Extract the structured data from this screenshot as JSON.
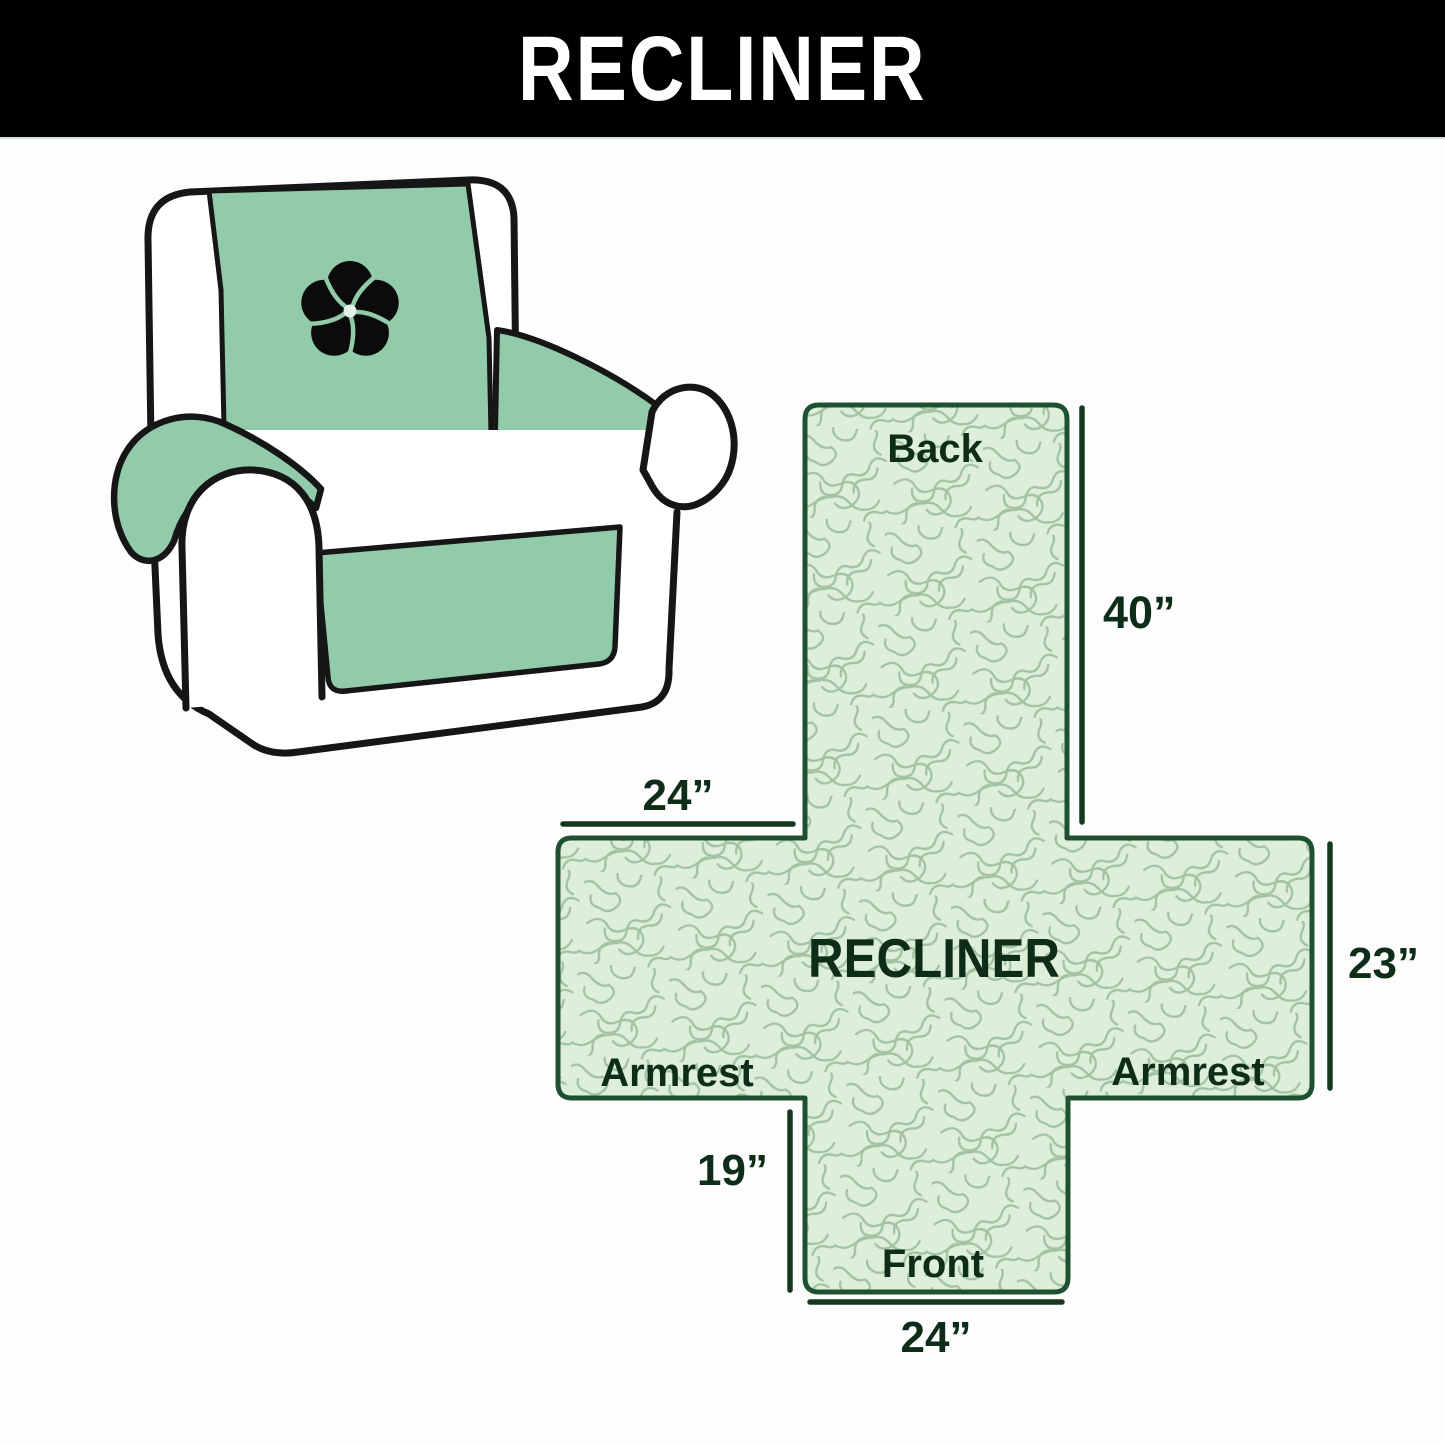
{
  "header": {
    "title": "RECLINER",
    "bg_color": "#000000",
    "text_color": "#ffffff"
  },
  "chair": {
    "description": "armchair with quilted recliner cover draped over back, seat and armrests",
    "cover_color": "#92cba9",
    "outline_color": "#161616",
    "logo": "pinwheel-logo"
  },
  "diagram": {
    "center_label": "RECLINER",
    "fill_color": "#ddefd9",
    "pattern_color": "#a3c2a3",
    "border_color": "#1e5130",
    "line_color": "#16381f",
    "text_color": "#0e2d18",
    "labels": {
      "back": "Back",
      "front": "Front",
      "armrest_left": "Armrest",
      "armrest_right": "Armrest"
    },
    "dimensions": {
      "back_height": "40”",
      "armrest_top_width": "24”",
      "side_height": "23”",
      "front_flap_height": "19”",
      "front_width": "24”"
    }
  }
}
